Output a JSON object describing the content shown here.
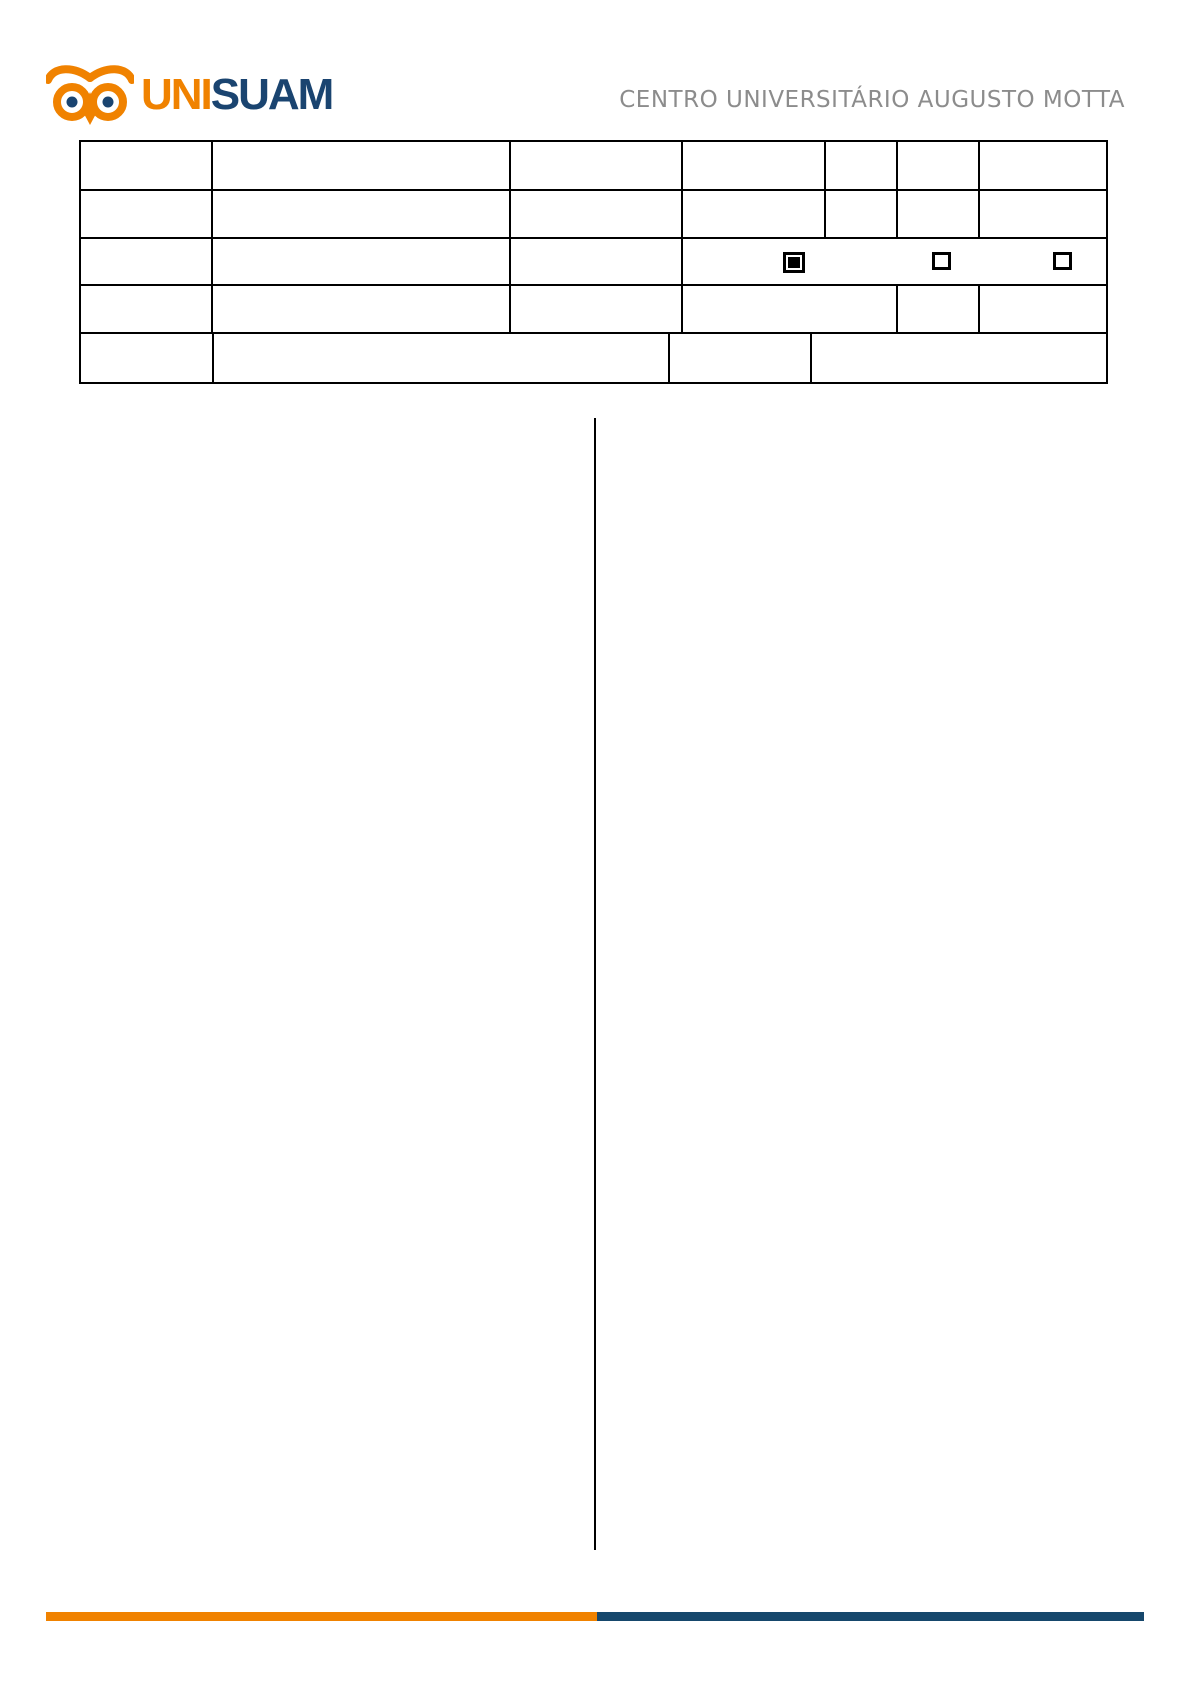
{
  "logo": {
    "icon": "owl-icon",
    "brand_primary": "UNI",
    "brand_secondary": "SUAM"
  },
  "header": {
    "institution": "CENTRO UNIVERSITÁRIO AUGUSTO MOTTA"
  },
  "colors": {
    "brand_orange": "#F08200",
    "brand_navy": "#1A4470",
    "footer_navy": "#16476C",
    "header_text_gray": "#8C8C8C",
    "table_border": "#000000"
  },
  "form_table": {
    "rows": [
      {
        "cells": [
          "",
          "",
          "",
          "",
          "",
          "",
          ""
        ]
      },
      {
        "cells": [
          "",
          "",
          "",
          "",
          "",
          "",
          ""
        ]
      },
      {
        "cells": [
          "",
          "",
          "",
          ""
        ]
      },
      {
        "cells": [
          "",
          "",
          "",
          "",
          "",
          ""
        ]
      },
      {
        "cells": [
          "",
          "",
          "",
          ""
        ]
      }
    ],
    "checkboxes": [
      {
        "checked": true
      },
      {
        "checked": false
      },
      {
        "checked": false
      }
    ]
  }
}
